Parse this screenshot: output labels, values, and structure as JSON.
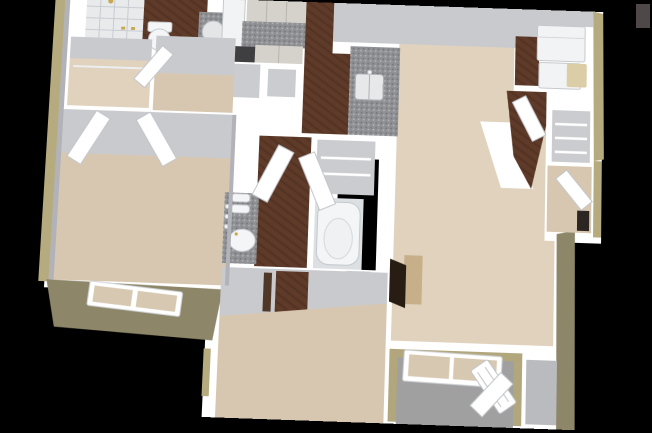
{
  "scene": {
    "kind": "3d-floor-plan-rendering",
    "view": "isometric-dollhouse",
    "rooms": [
      {
        "name": "bathroom-1",
        "floor": "hardwood",
        "fixtures": [
          "walk-in-tiled-shower",
          "brass-shower-head",
          "toilet",
          "granite-vanity",
          "round-mirror"
        ]
      },
      {
        "name": "walk-in-closet",
        "floor": "carpet",
        "fixtures": [
          "closet-rod"
        ]
      },
      {
        "name": "bedroom-1",
        "floor": "carpet",
        "fixtures": [
          "double-doors",
          "exterior-window"
        ]
      },
      {
        "name": "kitchen",
        "floor": "hardwood",
        "fixtures": [
          "upper-cabinets",
          "granite-countertop",
          "refrigerator",
          "range",
          "peninsula-counter",
          "kitchen-sink"
        ]
      },
      {
        "name": "great-room",
        "floor": "carpet",
        "fixtures": [
          "corner-fireplace"
        ]
      },
      {
        "name": "laundry-room",
        "floor": "hardwood",
        "fixtures": [
          "washer",
          "dryer",
          "hamper"
        ]
      },
      {
        "name": "entry-foyer",
        "floor": "carpet",
        "fixtures": [
          "coat-closet-wire-shelves",
          "front-door"
        ]
      },
      {
        "name": "bathroom-2",
        "floor": "hardwood",
        "fixtures": [
          "granite-vanity",
          "oval-sink",
          "rolled-towels",
          "bathtub",
          "toilet",
          "linen-closet"
        ]
      },
      {
        "name": "bedroom-2",
        "floor": "carpet",
        "fixtures": [
          "entry-door"
        ]
      },
      {
        "name": "patio",
        "floor": "concrete",
        "fixtures": [
          "picture-window",
          "french-door",
          "storage-closet"
        ]
      }
    ],
    "artifacts": [
      {
        "name": "gray-rectangle-watermark",
        "position": "top-right",
        "color_ref": "watermark"
      }
    ]
  },
  "palette": {
    "background": "#000000",
    "wall": "#ffffff",
    "wall_face": "#c9cace",
    "wall_face_dark": "#b2b3b9",
    "exterior_trim": "#b6ab7e",
    "exterior_face": "#8d8669",
    "patio_inner": "#b1a67c",
    "carpet": "#d8c7b0",
    "carpet_light": "#e0d2bd",
    "wood": "#5d3928",
    "wood_grain": "#3a2216",
    "granite": "#909194",
    "tile": "#e8eaec",
    "tile_line": "#c7ccd1",
    "appliance": "#f2f3f4",
    "cabinet": "#d5d2cb",
    "cabinet_line": "#b7b4ad",
    "concrete": "#a0a0a1",
    "storage_floor": "#babbbe",
    "closet_floor": "#cbcccf",
    "fixture_white": "#f4f5f6",
    "fixture_line": "#c5c9cc",
    "window_pane": "#d7c8b1",
    "door_edge": "#c2c5c9",
    "brass": "#c9a94e",
    "fireplace_dark": "#271d12",
    "fireplace_tan": "#c7b089",
    "dark_opening": "#2c2622",
    "watermark": "#4e4849"
  }
}
